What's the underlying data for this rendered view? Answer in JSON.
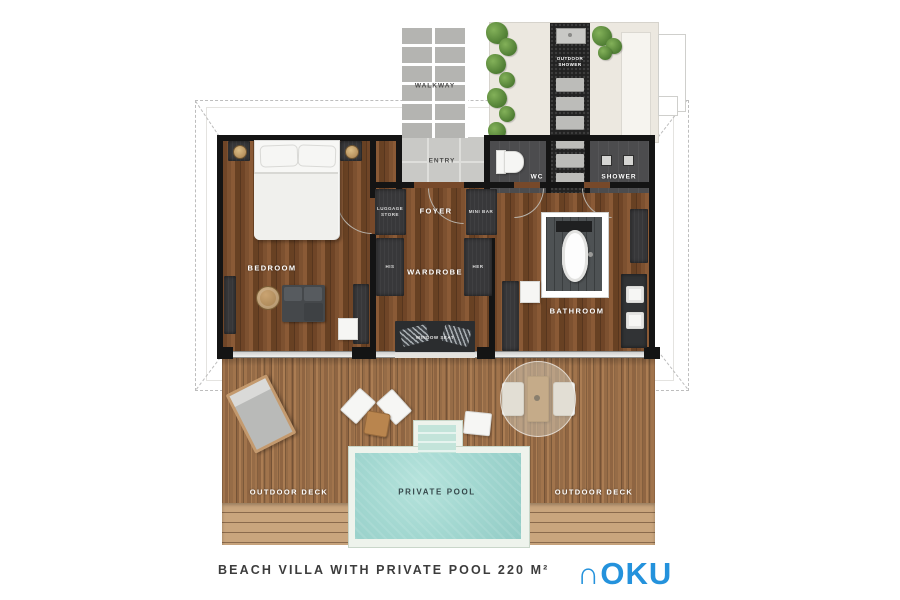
{
  "plan": {
    "areas": {
      "walkway": {
        "label": "WALKWAY"
      },
      "entry": {
        "label": "ENTRY"
      },
      "outdoor_shower": {
        "label": "OUTDOOR SHOWER"
      },
      "wc": {
        "label": "WC"
      },
      "shower": {
        "label": "SHOWER"
      },
      "foyer": {
        "label": "FOYER"
      },
      "luggage_store": {
        "label": "LUGGAGE STORE"
      },
      "mini_bar": {
        "label": "MINI BAR"
      },
      "bedroom": {
        "label": "BEDROOM"
      },
      "wardrobe": {
        "label": "WARDROBE"
      },
      "wardrobe_his": {
        "label": "HIS"
      },
      "wardrobe_her": {
        "label": "HER"
      },
      "window_seat": {
        "label": "WINDOW SEAT"
      },
      "bathroom": {
        "label": "BATHROOM"
      },
      "outdoor_deck_left": {
        "label": "OUTDOOR DECK"
      },
      "outdoor_deck_right": {
        "label": "OUTDOOR DECK"
      },
      "private_pool": {
        "label": "PRIVATE POOL"
      }
    }
  },
  "footer": {
    "caption": "BEACH VILLA WITH PRIVATE POOL 220 M²",
    "logo_text": "∩OKU"
  },
  "colors": {
    "wood_interior": "#77492a",
    "wood_deck": "#9c7049",
    "pool_water": "#a3d8d1",
    "wall": "#141414",
    "cabinet": "#38383a",
    "wet_room_tile": "#4c4c4e",
    "sand": "#ece8e0",
    "plant_green": "#4e7c33",
    "paver_grey": "#b4b4b1",
    "logo_blue": "#2492dc",
    "caption_text": "#3c3c3c"
  }
}
